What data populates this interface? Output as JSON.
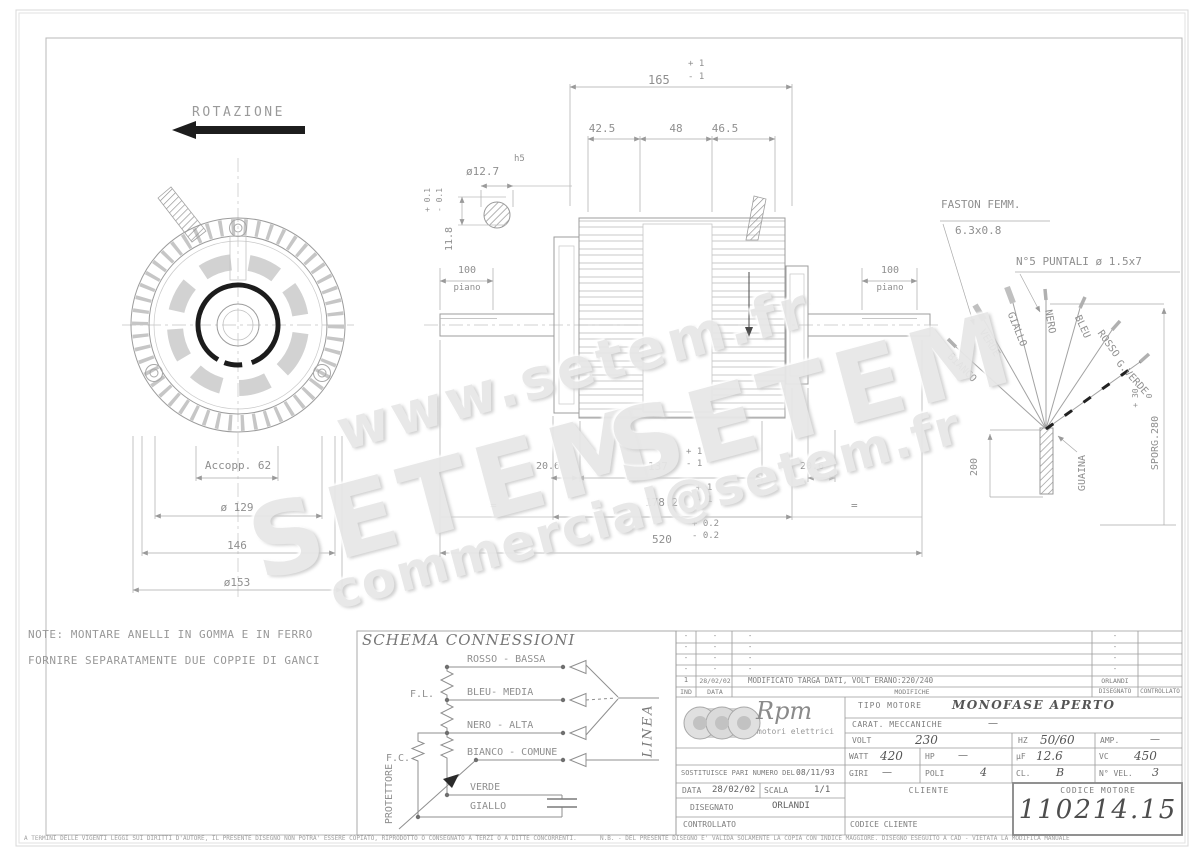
{
  "watermark": {
    "url": "www.setem.fr",
    "brand1": "SETEM",
    "brand2": "SETEM",
    "email": "commercial@setem.fr"
  },
  "front_view": {
    "rotation": "ROTAZIONE",
    "dim_accopp": "Accopp. 62",
    "dim_d129": "ø 129",
    "dim_146": "146",
    "dim_d153": "ø153"
  },
  "side_view": {
    "dim_165": "165",
    "tol_165_p": "+ 1",
    "tol_165_m": "- 1",
    "dim_425": "42.5",
    "dim_48": "48",
    "dim_465": "46.5",
    "dim_d127": "ø12.7",
    "fit_h5": "h5",
    "dim_118": "11.8",
    "tol_118_p": "+ 0.1",
    "tol_118_m": "- 0.1",
    "dim_100L": "100",
    "piano_L": "piano",
    "dim_100R": "100",
    "piano_R": "piano",
    "dim_206L": "20.6",
    "dim_137": "137",
    "tol_137_p": "+ 1",
    "tol_137_m": "- 1",
    "dim_206R": "20.6",
    "dim_1782": "178.2",
    "tol_1782_p": "+ 1",
    "tol_1782_m": "- 1",
    "dim_520": "520",
    "tol_520_p": "+ 0.2",
    "tol_520_m": "- 0.2",
    "eq_left": "=",
    "eq_right": "="
  },
  "cable": {
    "faston1": "FASTON FEMM.",
    "faston2": "6.3x0.8",
    "puntali": "N°5 PUNTALI ø 1.5x7",
    "wire_bianco": "BIANCO",
    "wire_verde": "VERDE",
    "wire_giallo": "GIALLO",
    "wire_nero": "NERO",
    "wire_bleu": "BLEU",
    "wire_rosso": "ROSSO",
    "wire_gverde": "G.VERDE",
    "dim_200": "200",
    "guaina": "GUAINA",
    "sporg": "SPORG.280",
    "sporg_p": "+ 30",
    "sporg_m": "0"
  },
  "note": {
    "line1": "NOTE: MONTARE ANELLI IN GOMMA E IN FERRO",
    "line2": "FORNIRE SEPARATAMENTE DUE COPPIE DI GANCI"
  },
  "schema": {
    "title": "SCHEMA CONNESSIONI",
    "rosso": "ROSSO - BASSA",
    "bleu": "BLEU- MEDIA",
    "nero": "NERO - ALTA",
    "bianco": "BIANCO - COMUNE",
    "verde": "VERDE",
    "giallo": "GIALLO",
    "fl": "F.L.",
    "fc": "F.C.",
    "protettore": "PROTETTORE",
    "linea": "LINEA"
  },
  "revisions": {
    "headers": {
      "ind": "IND",
      "data": "DATA",
      "modifiche": "MODIFICHE",
      "disegnato": "DISEGNATO",
      "controllato": "CONTROLLATO"
    },
    "rows": [
      {
        "ind": "-",
        "data": "-",
        "modifiche": "-",
        "disegnato": "-"
      },
      {
        "ind": "-",
        "data": "-",
        "modifiche": "-",
        "disegnato": "-"
      },
      {
        "ind": "-",
        "data": "-",
        "modifiche": "-",
        "disegnato": "-"
      },
      {
        "ind": "-",
        "data": "-",
        "modifiche": "-",
        "disegnato": "-"
      },
      {
        "ind": "1",
        "data": "28/02/02",
        "modifiche": "MODIFICATO TARGA DATI, VOLT ERANO:220/240",
        "disegnato": "ORLANDI"
      }
    ]
  },
  "titleblock": {
    "brand": "Rpm",
    "brand_sub": "motori elettrici",
    "tipo_label": "TIPO MOTORE",
    "tipo_value": "MONOFASE APERTO",
    "carat_label": "CARAT. MECCANICHE",
    "carat_value": "—",
    "volt_label": "VOLT",
    "volt_value": "230",
    "hz_label": "HZ",
    "hz_value": "50/60",
    "amp_label": "AMP.",
    "amp_value": "—",
    "watt_label": "WATT",
    "watt_value": "420",
    "hp_label": "HP",
    "hp_value": "—",
    "uf_label": "µF",
    "uf_value": "12.6",
    "vc_label": "VC",
    "vc_value": "450",
    "sost_label": "SOSTITUISCE PARI NUMERO DEL",
    "sost_value": "08/11/93",
    "giri_label": "GIRI",
    "giri_value": "—",
    "poli_label": "POLI",
    "poli_value": "4",
    "cl_label": "CL.",
    "cl_value": "B",
    "nvel_label": "N° VEL.",
    "nvel_value": "3",
    "data_label": "DATA",
    "data_value": "28/02/02",
    "scala_label": "SCALA",
    "scala_value": "1/1",
    "cliente_label": "CLIENTE",
    "codcli_label": "CODICE CLIENTE",
    "disegnato_label": "DISEGNATO",
    "disegnato_value": "ORLANDI",
    "controllato_label": "CONTROLLATO",
    "codmot_label": "CODICE MOTORE",
    "codmot_value": "110214.15"
  },
  "footer": {
    "left": "A TERMINI DELLE VIGENTI LEGGI SUI DIRITTI D'AUTORE, IL PRESENTE DISEGNO NON POTRA' ESSERE COPIATO, RIPRODOTTO O CONSEGNATO A TERZI O A DITTE CONCORRENTI.",
    "right": "N.B. - DEL PRESENTE DISEGNO E' VALIDA SOLAMENTE LA COPIA CON INDICE MAGGIORE.      DISEGNO ESEGUITO A CAD - VIETATA LA MODIFICA MANUALE"
  }
}
